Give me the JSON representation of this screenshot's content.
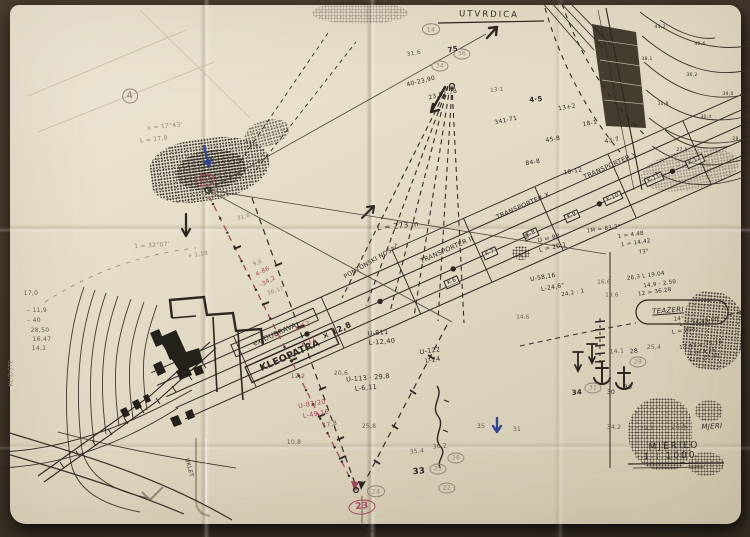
{
  "colors": {
    "bg": "#463c30",
    "paper": "#e3dcc8",
    "ink": "#2b261f",
    "pencil": "#8f8676",
    "grey": "#5f584a",
    "red": "#a8445a",
    "blue": "#2f4496"
  },
  "map": {
    "title": "UTVRDICA",
    "scale_label": "MJERILO",
    "scale_value": "1 : 1000",
    "route_names": [
      "KLEOPATRA",
      "ex.DUBRAVA",
      "TRANSPORTER II",
      "TRANSPORTER X",
      "TRANSPORTER Y",
      "TEAZERI",
      "PONTONSKI NOSAČ"
    ]
  },
  "annotations": [
    {
      "x": 489,
      "y": 15,
      "t": "UTVRDICA",
      "c": "ink",
      "s": 8.5,
      "r": 1,
      "f": "ls"
    },
    {
      "x": 674,
      "y": 447,
      "t": "MJERILO",
      "c": "ink",
      "s": 9,
      "r": -2,
      "f": "ls"
    },
    {
      "x": 670,
      "y": 457,
      "t": "1 : 1000",
      "c": "ink",
      "s": 9,
      "r": -2,
      "f": "ls"
    },
    {
      "x": 712,
      "y": 427,
      "t": "MJERI",
      "c": "ink",
      "s": 7,
      "r": -3,
      "f": "i"
    },
    {
      "x": 614,
      "y": 428,
      "t": "34,2",
      "c": "grey",
      "s": 6,
      "r": 0,
      "f": ""
    },
    {
      "x": 647,
      "y": 429,
      "t": "29,1",
      "c": "grey",
      "s": 6,
      "r": 0,
      "f": ""
    },
    {
      "x": 679,
      "y": 428,
      "t": "26,9",
      "c": "grey",
      "s": 6,
      "r": 0,
      "f": ""
    },
    {
      "x": 290,
      "y": 356,
      "t": "KLEOPATRA",
      "c": "ink",
      "s": 9.5,
      "r": -24,
      "f": "b"
    },
    {
      "x": 275,
      "y": 335,
      "t": "ex.DUBRAVA",
      "c": "ink",
      "s": 7,
      "r": -24,
      "f": ""
    },
    {
      "x": 303,
      "y": 326,
      "t": "K-52",
      "c": "red",
      "s": 6.5,
      "r": -24,
      "f": ""
    },
    {
      "x": 309,
      "y": 342,
      "t": "K-11",
      "c": "red",
      "s": 6.5,
      "r": -24,
      "f": ""
    },
    {
      "x": 337,
      "y": 331,
      "t": "× 12,8",
      "c": "ink",
      "s": 8,
      "r": -24,
      "f": "b"
    },
    {
      "x": 447,
      "y": 250,
      "t": "TRANSPORTER II",
      "c": "ink",
      "s": 6.5,
      "r": -24,
      "f": ""
    },
    {
      "x": 523,
      "y": 206,
      "t": "TRANSPORTER X",
      "c": "ink",
      "s": 6.5,
      "r": -24,
      "f": ""
    },
    {
      "x": 610,
      "y": 166,
      "t": "TRANSPORTER Y",
      "c": "ink",
      "s": 6.5,
      "r": -24,
      "f": ""
    },
    {
      "x": 452,
      "y": 282,
      "t": "K-6",
      "c": "ink",
      "s": 5.5,
      "r": -24,
      "f": "box"
    },
    {
      "x": 490,
      "y": 253,
      "t": "K-7",
      "c": "ink",
      "s": 5.5,
      "r": -24,
      "f": "box"
    },
    {
      "x": 531,
      "y": 234,
      "t": "K-8",
      "c": "ink",
      "s": 5.5,
      "r": -24,
      "f": "box"
    },
    {
      "x": 572,
      "y": 216,
      "t": "K-9",
      "c": "ink",
      "s": 5.5,
      "r": -24,
      "f": "box"
    },
    {
      "x": 613,
      "y": 198,
      "t": "K-10",
      "c": "ink",
      "s": 5.5,
      "r": -24,
      "f": "box"
    },
    {
      "x": 654,
      "y": 179,
      "t": "K-11",
      "c": "ink",
      "s": 5.5,
      "r": -24,
      "f": "box"
    },
    {
      "x": 695,
      "y": 161,
      "t": "K-12",
      "c": "ink",
      "s": 5.5,
      "r": -24,
      "f": "box"
    },
    {
      "x": 398,
      "y": 226,
      "t": "L = 273 m",
      "c": "ink",
      "s": 7.5,
      "r": -6,
      "f": ""
    },
    {
      "x": 372,
      "y": 262,
      "t": "PONTONSKI NOSAČ",
      "c": "ink",
      "s": 6,
      "r": -30,
      "f": ""
    },
    {
      "x": 378,
      "y": 333,
      "t": "U-811",
      "c": "ink",
      "s": 6.5,
      "r": -5,
      "f": ""
    },
    {
      "x": 382,
      "y": 342,
      "t": "L-12,40",
      "c": "ink",
      "s": 6.5,
      "r": -5,
      "f": ""
    },
    {
      "x": 430,
      "y": 351,
      "t": "U-122",
      "c": "ink",
      "s": 6.5,
      "r": -8,
      "f": ""
    },
    {
      "x": 433,
      "y": 360,
      "t": "L-24",
      "c": "ink",
      "s": 6.5,
      "r": -8,
      "f": ""
    },
    {
      "x": 368,
      "y": 378,
      "t": "U-113 · 29,8",
      "c": "ink",
      "s": 6.5,
      "r": -5,
      "f": ""
    },
    {
      "x": 366,
      "y": 388,
      "t": "L-6,11",
      "c": "ink",
      "s": 6.5,
      "r": -5,
      "f": ""
    },
    {
      "x": 298,
      "y": 377,
      "t": "12,2",
      "c": "grey",
      "s": 6,
      "r": 0,
      "f": ""
    },
    {
      "x": 341,
      "y": 374,
      "t": "20,6",
      "c": "grey",
      "s": 6,
      "r": 0,
      "f": ""
    },
    {
      "x": 312,
      "y": 404,
      "t": "U-83/20",
      "c": "red",
      "s": 6.5,
      "r": -10,
      "f": ""
    },
    {
      "x": 316,
      "y": 414,
      "t": "L-49,16",
      "c": "red",
      "s": 6.5,
      "r": -10,
      "f": ""
    },
    {
      "x": 330,
      "y": 425,
      "t": "17,8",
      "c": "grey",
      "s": 6,
      "r": -10,
      "f": ""
    },
    {
      "x": 369,
      "y": 427,
      "t": "25,8",
      "c": "grey",
      "s": 6,
      "r": 0,
      "f": ""
    },
    {
      "x": 294,
      "y": 443,
      "t": "10,8",
      "c": "grey",
      "s": 6,
      "r": 0,
      "f": ""
    },
    {
      "x": 263,
      "y": 272,
      "t": "4-86",
      "c": "red",
      "s": 6,
      "r": -28,
      "f": ""
    },
    {
      "x": 268,
      "y": 282,
      "t": "-34,2",
      "c": "red",
      "s": 6,
      "r": -28,
      "f": ""
    },
    {
      "x": 258,
      "y": 264,
      "t": "9,6",
      "c": "pencil",
      "s": 5.5,
      "r": -20,
      "f": ""
    },
    {
      "x": 276,
      "y": 292,
      "t": "36,17",
      "c": "pencil",
      "s": 5.5,
      "r": -20,
      "f": ""
    },
    {
      "x": 165,
      "y": 127,
      "t": "x = 17°43'",
      "c": "pencil",
      "s": 6,
      "r": -6,
      "f": ""
    },
    {
      "x": 154,
      "y": 140,
      "t": "L = 17,8",
      "c": "pencil",
      "s": 6,
      "r": -6,
      "f": ""
    },
    {
      "x": 152,
      "y": 246,
      "t": "1 = 32°07'",
      "c": "pencil",
      "s": 6,
      "r": -4,
      "f": ""
    },
    {
      "x": 198,
      "y": 256,
      "t": "+ 1,18",
      "c": "pencil",
      "s": 5.5,
      "r": -10,
      "f": ""
    },
    {
      "x": 244,
      "y": 218,
      "t": "31,8",
      "c": "pencil",
      "s": 5.5,
      "r": -15,
      "f": ""
    },
    {
      "x": 31,
      "y": 294,
      "t": "17,0",
      "c": "grey",
      "s": 6,
      "r": 0,
      "f": ""
    },
    {
      "x": 37,
      "y": 311,
      "t": "– 11,9",
      "c": "grey",
      "s": 6,
      "r": 0,
      "f": ""
    },
    {
      "x": 34,
      "y": 321,
      "t": "– 40",
      "c": "grey",
      "s": 6,
      "r": 0,
      "f": ""
    },
    {
      "x": 40,
      "y": 331,
      "t": "28,50",
      "c": "grey",
      "s": 6,
      "r": 0,
      "f": ""
    },
    {
      "x": 42,
      "y": 340,
      "t": "16,47",
      "c": "grey",
      "s": 6,
      "r": 0,
      "f": ""
    },
    {
      "x": 39,
      "y": 349,
      "t": "14,1",
      "c": "grey",
      "s": 6,
      "r": 0,
      "f": ""
    },
    {
      "x": 12,
      "y": 373,
      "t": "KLIZIŠTE",
      "c": "pencil",
      "s": 5.5,
      "r": -90,
      "f": ""
    },
    {
      "x": 188,
      "y": 468,
      "t": "UKLET",
      "c": "ink",
      "s": 5.5,
      "r": 75,
      "f": ""
    },
    {
      "x": 419,
      "y": 472,
      "t": "33",
      "c": "ink",
      "s": 8.5,
      "r": -5,
      "f": "b"
    },
    {
      "x": 438,
      "y": 469,
      "t": "25",
      "c": "pencil",
      "s": 6,
      "r": 0,
      "f": "circ"
    },
    {
      "x": 456,
      "y": 458,
      "t": "26",
      "c": "pencil",
      "s": 6,
      "r": 0,
      "f": "circ"
    },
    {
      "x": 447,
      "y": 488,
      "t": "22",
      "c": "pencil",
      "s": 6,
      "r": 0,
      "f": "circ"
    },
    {
      "x": 417,
      "y": 452,
      "t": "35,4",
      "c": "grey",
      "s": 6,
      "r": -5,
      "f": ""
    },
    {
      "x": 440,
      "y": 447,
      "t": "36,2",
      "c": "grey",
      "s": 6,
      "r": -5,
      "f": ""
    },
    {
      "x": 376,
      "y": 491,
      "t": "24",
      "c": "pencil",
      "s": 6.5,
      "r": 0,
      "f": "circ"
    },
    {
      "x": 362,
      "y": 507,
      "t": "23",
      "c": "red",
      "s": 9,
      "r": -5,
      "f": "b rcirc"
    },
    {
      "x": 481,
      "y": 427,
      "t": "35",
      "c": "grey",
      "s": 6,
      "r": 0,
      "f": ""
    },
    {
      "x": 517,
      "y": 430,
      "t": "31",
      "c": "grey",
      "s": 6,
      "r": 0,
      "f": ""
    },
    {
      "x": 577,
      "y": 393,
      "t": "34",
      "c": "ink",
      "s": 7,
      "r": -5,
      "f": "b"
    },
    {
      "x": 593,
      "y": 388,
      "t": "31",
      "c": "pencil",
      "s": 6,
      "r": 0,
      "f": "circ"
    },
    {
      "x": 611,
      "y": 393,
      "t": "30",
      "c": "ink",
      "s": 6,
      "r": 0,
      "f": ""
    },
    {
      "x": 628,
      "y": 388,
      "t": "30",
      "c": "ink",
      "s": 6,
      "r": 0,
      "f": ""
    },
    {
      "x": 638,
      "y": 362,
      "t": "29",
      "c": "pencil",
      "s": 6,
      "r": 0,
      "f": "circ"
    },
    {
      "x": 654,
      "y": 348,
      "t": "25,4",
      "c": "grey",
      "s": 6,
      "r": 0,
      "f": ""
    },
    {
      "x": 634,
      "y": 352,
      "t": "28",
      "c": "ink",
      "s": 6,
      "r": -5,
      "f": ""
    },
    {
      "x": 617,
      "y": 352,
      "t": "14,1",
      "c": "grey",
      "s": 6,
      "r": -5,
      "f": ""
    },
    {
      "x": 668,
      "y": 311,
      "t": "TEAZERI",
      "c": "ink",
      "s": 7,
      "r": -4,
      "f": "i u"
    },
    {
      "x": 646,
      "y": 277,
      "t": "26,3  L 19.04",
      "c": "ink",
      "s": 5.5,
      "r": -8,
      "f": ""
    },
    {
      "x": 660,
      "y": 285,
      "t": "14,9 · 2.50",
      "c": "ink",
      "s": 5.5,
      "r": -8,
      "f": ""
    },
    {
      "x": 655,
      "y": 293,
      "t": "12 = 36.28",
      "c": "ink",
      "s": 5.5,
      "r": -8,
      "f": ""
    },
    {
      "x": 679,
      "y": 320,
      "t": "14°",
      "c": "ink",
      "s": 5.5,
      "r": -5,
      "f": ""
    },
    {
      "x": 699,
      "y": 323,
      "t": "L = 14.48.00",
      "c": "ink",
      "s": 5.5,
      "r": -8,
      "f": ""
    },
    {
      "x": 684,
      "y": 332,
      "t": "L = 253",
      "c": "ink",
      "s": 5.5,
      "r": -8,
      "f": ""
    },
    {
      "x": 701,
      "y": 346,
      "t": "13,41 = 75.18",
      "c": "ink",
      "s": 5.5,
      "r": -8,
      "f": ""
    },
    {
      "x": 703,
      "y": 353,
      "t": "L m 4,25",
      "c": "ink",
      "s": 5.5,
      "r": -8,
      "f": ""
    },
    {
      "x": 705,
      "y": 359,
      "t": "L = 27.30",
      "c": "ink",
      "s": 5.5,
      "r": -8,
      "f": ""
    },
    {
      "x": 604,
      "y": 283,
      "t": "16,6",
      "c": "grey",
      "s": 5.5,
      "r": 0,
      "f": ""
    },
    {
      "x": 549,
      "y": 239,
      "t": "U = 98",
      "c": "ink",
      "s": 6,
      "r": -12,
      "f": ""
    },
    {
      "x": 553,
      "y": 248,
      "t": "L = 20,1",
      "c": "ink",
      "s": 6,
      "r": -12,
      "f": ""
    },
    {
      "x": 604,
      "y": 230,
      "t": "1M = 83,2°",
      "c": "ink",
      "s": 5.5,
      "r": -8,
      "f": ""
    },
    {
      "x": 631,
      "y": 236,
      "t": "1 = 4.48",
      "c": "ink",
      "s": 5.5,
      "r": -8,
      "f": ""
    },
    {
      "x": 636,
      "y": 244,
      "t": "1 = 14,42",
      "c": "ink",
      "s": 5.5,
      "r": -8,
      "f": ""
    },
    {
      "x": 644,
      "y": 253,
      "t": "73°",
      "c": "ink",
      "s": 5.5,
      "r": -8,
      "f": ""
    },
    {
      "x": 543,
      "y": 278,
      "t": "U-58,16",
      "c": "ink",
      "s": 6,
      "r": -10,
      "f": ""
    },
    {
      "x": 553,
      "y": 288,
      "t": "L-24,6°",
      "c": "ink",
      "s": 6,
      "r": -10,
      "f": ""
    },
    {
      "x": 573,
      "y": 294,
      "t": "24,2 : 1",
      "c": "ink",
      "s": 5.5,
      "r": -10,
      "f": ""
    },
    {
      "x": 612,
      "y": 296,
      "t": "13,6",
      "c": "grey",
      "s": 5.5,
      "r": 0,
      "f": ""
    },
    {
      "x": 523,
      "y": 318,
      "t": "14,6",
      "c": "grey",
      "s": 5.5,
      "r": 0,
      "f": ""
    },
    {
      "x": 431,
      "y": 29,
      "t": "14",
      "c": "pencil",
      "s": 6.5,
      "r": 0,
      "f": "circ"
    },
    {
      "x": 414,
      "y": 54,
      "t": "31,6",
      "c": "grey",
      "s": 6,
      "r": -10,
      "f": ""
    },
    {
      "x": 440,
      "y": 66,
      "t": "34",
      "c": "pencil",
      "s": 6,
      "r": 0,
      "f": "circ"
    },
    {
      "x": 462,
      "y": 54,
      "t": "36",
      "c": "pencil",
      "s": 6,
      "r": 0,
      "f": "circ"
    },
    {
      "x": 453,
      "y": 50,
      "t": "75",
      "c": "ink",
      "s": 7,
      "r": -10,
      "f": "b"
    },
    {
      "x": 421,
      "y": 82,
      "t": "40-23,90",
      "c": "ink",
      "s": 6,
      "r": -14,
      "f": ""
    },
    {
      "x": 443,
      "y": 95,
      "t": "23,52-78",
      "c": "ink",
      "s": 6,
      "r": -14,
      "f": ""
    },
    {
      "x": 497,
      "y": 91,
      "t": "13·1",
      "c": "grey",
      "s": 5.5,
      "r": -5,
      "f": ""
    },
    {
      "x": 506,
      "y": 121,
      "t": "341-71",
      "c": "ink",
      "s": 6,
      "r": -12,
      "f": ""
    },
    {
      "x": 536,
      "y": 100,
      "t": "4·5",
      "c": "ink",
      "s": 7,
      "r": -5,
      "f": "b"
    },
    {
      "x": 553,
      "y": 140,
      "t": "45-8",
      "c": "ink",
      "s": 6,
      "r": -10,
      "f": ""
    },
    {
      "x": 567,
      "y": 108,
      "t": "13+2",
      "c": "ink",
      "s": 6,
      "r": -10,
      "f": ""
    },
    {
      "x": 590,
      "y": 124,
      "t": "18-1",
      "c": "ink",
      "s": 6,
      "r": -10,
      "f": ""
    },
    {
      "x": 533,
      "y": 163,
      "t": "84-8",
      "c": "ink",
      "s": 6,
      "r": -10,
      "f": ""
    },
    {
      "x": 573,
      "y": 172,
      "t": "10-12",
      "c": "ink",
      "s": 6,
      "r": -10,
      "f": ""
    },
    {
      "x": 612,
      "y": 141,
      "t": "43-7",
      "c": "ink",
      "s": 6,
      "r": -10,
      "f": ""
    },
    {
      "x": 660,
      "y": 28,
      "t": "44,2",
      "c": "ink",
      "s": 4.5,
      "r": 0,
      "f": ""
    },
    {
      "x": 700,
      "y": 45,
      "t": "40,6",
      "c": "ink",
      "s": 4.5,
      "r": 0,
      "f": ""
    },
    {
      "x": 647,
      "y": 60,
      "t": "38,1",
      "c": "ink",
      "s": 4.5,
      "r": 0,
      "f": ""
    },
    {
      "x": 692,
      "y": 76,
      "t": "36,2",
      "c": "ink",
      "s": 4.5,
      "r": 0,
      "f": ""
    },
    {
      "x": 728,
      "y": 95,
      "t": "34,0",
      "c": "ink",
      "s": 4.5,
      "r": 0,
      "f": ""
    },
    {
      "x": 663,
      "y": 105,
      "t": "31,8",
      "c": "ink",
      "s": 4.5,
      "r": 0,
      "f": ""
    },
    {
      "x": 706,
      "y": 118,
      "t": "30,4",
      "c": "ink",
      "s": 4.5,
      "r": 0,
      "f": ""
    },
    {
      "x": 738,
      "y": 140,
      "t": "28,7",
      "c": "ink",
      "s": 4.5,
      "r": 0,
      "f": ""
    },
    {
      "x": 682,
      "y": 151,
      "t": "27,5",
      "c": "ink",
      "s": 4.5,
      "r": 0,
      "f": ""
    },
    {
      "x": 130,
      "y": 96,
      "t": "4",
      "c": "pencil",
      "s": 10,
      "r": -8,
      "f": "circ"
    },
    {
      "x": 205,
      "y": 180,
      "t": "DM",
      "c": "red",
      "s": 6.5,
      "r": -10,
      "f": "circ"
    }
  ]
}
